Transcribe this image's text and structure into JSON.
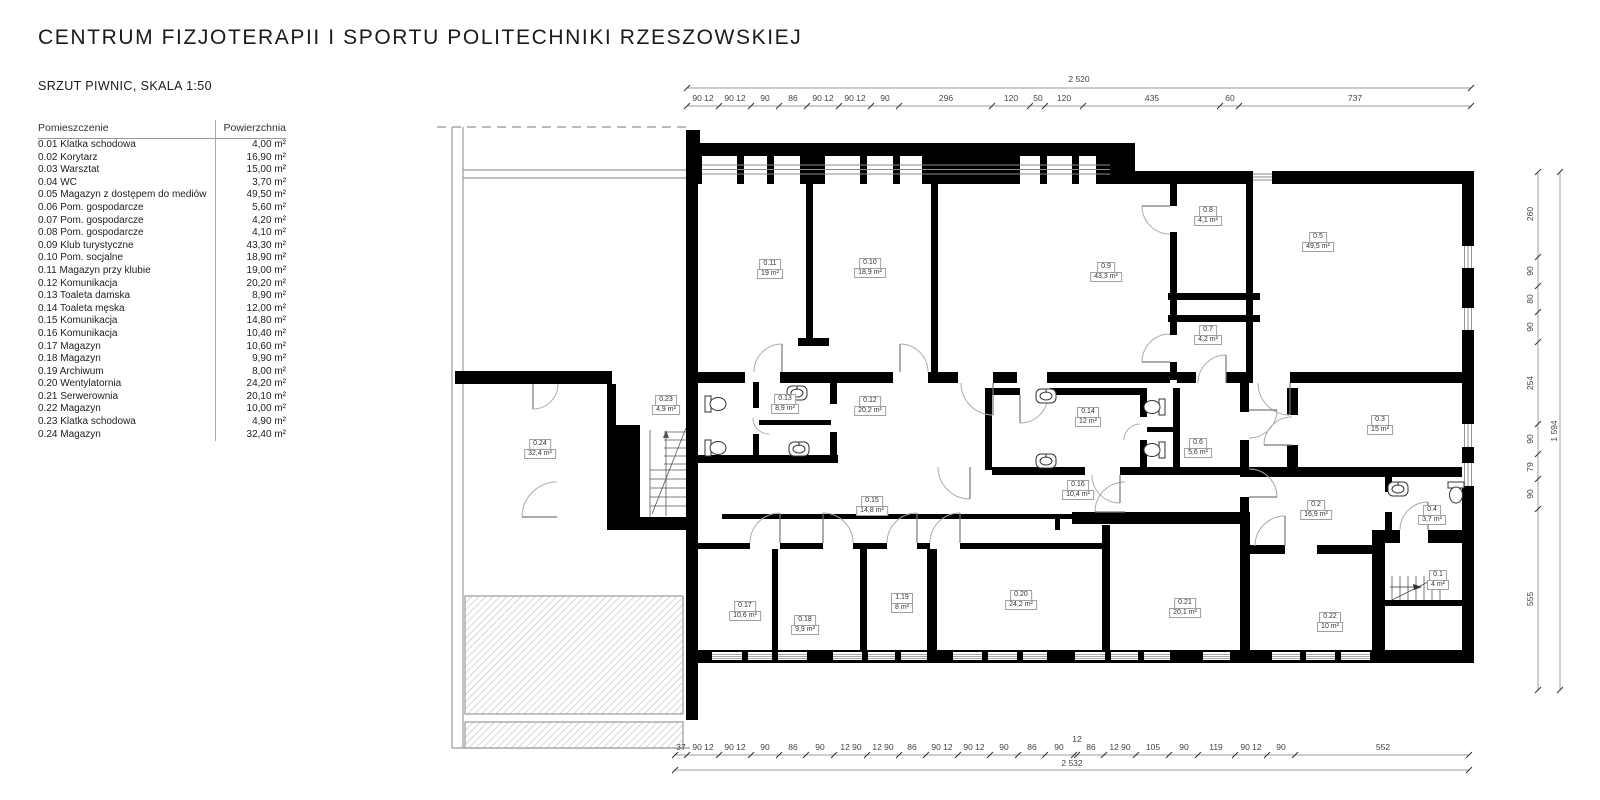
{
  "header": {
    "title": "CENTRUM FIZJOTERAPII I SPORTU POLITECHNIKI RZESZOWSKIEJ",
    "subtitle": "SRZUT PIWNIC, SKALA 1:50"
  },
  "colors": {
    "wall": "#000000",
    "thin_line": "#9a9a9a",
    "text": "#1a1a1a"
  },
  "legend": {
    "col_room": "Pomieszczenie",
    "col_area": "Powierzchnia",
    "rows": [
      {
        "name": "0.01 Klatka schodowa",
        "area": "4,00 m²"
      },
      {
        "name": "0.02 Korytarz",
        "area": "16,90 m²"
      },
      {
        "name": "0.03 Warsztat",
        "area": "15,00 m²"
      },
      {
        "name": "0.04 WC",
        "area": "3,70 m²"
      },
      {
        "name": "0.05 Magazyn z dostępem do mediów",
        "area": "49,50 m²"
      },
      {
        "name": "0.06 Pom. gospodarcze",
        "area": "5,60 m²"
      },
      {
        "name": "0.07 Pom. gospodarcze",
        "area": "4,20 m²"
      },
      {
        "name": "0.08 Pom. gospodarcze",
        "area": "4,10 m²"
      },
      {
        "name": "0.09 Klub turystyczne",
        "area": "43,30 m²"
      },
      {
        "name": "0.10 Pom. socjalne",
        "area": "18,90 m²"
      },
      {
        "name": "0.11 Magazyn przy klubie",
        "area": "19,00 m²"
      },
      {
        "name": "0.12 Komunikacja",
        "area": "20,20 m²"
      },
      {
        "name": "0.13 Toaleta damska",
        "area": "8,90 m²"
      },
      {
        "name": "0.14 Toaleta męska",
        "area": "12,00 m²"
      },
      {
        "name": "0.15 Komunikacja",
        "area": "14,80 m²"
      },
      {
        "name": "0.16 Komunikacja",
        "area": "10,40 m²"
      },
      {
        "name": "0.17 Magazyn",
        "area": "10,60 m²"
      },
      {
        "name": "0.18 Magazyn",
        "area": "9,90 m²"
      },
      {
        "name": "0.19 Archiwum",
        "area": "8,00 m²"
      },
      {
        "name": "0.20 Wentylatornia",
        "area": "24,20 m²"
      },
      {
        "name": "0.21 Serwerownia",
        "area": "20,10 m²"
      },
      {
        "name": "0.22 Magazyn",
        "area": "10,00 m²"
      },
      {
        "name": "0.23 Klatka schodowa",
        "area": "4,90 m²"
      },
      {
        "name": "0.24 Magazyn",
        "area": "32,40 m²"
      }
    ]
  },
  "plan": {
    "icons": [
      "toilet-icon",
      "sink-icon",
      "stairs-icon",
      "door-arc-icon"
    ],
    "room_labels": [
      {
        "id": "0.11",
        "area": "19 m²"
      },
      {
        "id": "0.10",
        "area": "18,9 m²"
      },
      {
        "id": "0.9",
        "area": "43,3 m²"
      },
      {
        "id": "0.8",
        "area": "4,1 m²"
      },
      {
        "id": "0.5",
        "area": "49,5 m²"
      },
      {
        "id": "0.7",
        "area": "4,2 m²"
      },
      {
        "id": "0.23",
        "area": "4,9 m²"
      },
      {
        "id": "0.13",
        "area": "8,9 m²"
      },
      {
        "id": "0.12",
        "area": "20,2 m²"
      },
      {
        "id": "0.14",
        "area": "12 m²"
      },
      {
        "id": "0.6",
        "area": "5,6 m²"
      },
      {
        "id": "0.3",
        "area": "15 m²"
      },
      {
        "id": "0.24",
        "area": "32,4 m²"
      },
      {
        "id": "0.16",
        "area": "10,4 m²"
      },
      {
        "id": "0.15",
        "area": "14,8 m²"
      },
      {
        "id": "0.2",
        "area": "16,9 m²"
      },
      {
        "id": "0.4",
        "area": "3,7 m²"
      },
      {
        "id": "0.1",
        "area": "4 m²"
      },
      {
        "id": "0.17",
        "area": "10,6 m²"
      },
      {
        "id": "0.18",
        "area": "9,9 m²"
      },
      {
        "id": "1.19",
        "area": "8 m²"
      },
      {
        "id": "0.20",
        "area": "24,2 m²"
      },
      {
        "id": "0.21",
        "area": "20,1 m²"
      },
      {
        "id": "0.22",
        "area": "10 m²"
      }
    ]
  },
  "dimensions": {
    "top": {
      "total": "2 520",
      "segments": [
        "90 12",
        "90 12",
        "90",
        "86",
        "90 12",
        "90 12",
        "90",
        "296",
        "120",
        "50",
        "120",
        "435",
        "60",
        "737"
      ]
    },
    "bottom": {
      "total": "2 532",
      "extra": "12",
      "segments": [
        "37",
        "90 12",
        "90 12",
        "90",
        "86",
        "90",
        "12 90",
        "12 90",
        "86",
        "90 12",
        "90 12",
        "90",
        "86",
        "90",
        "86",
        "12 90",
        "105",
        "90",
        "119",
        "90 12",
        "90",
        "552"
      ]
    },
    "right": {
      "total": "1 594",
      "segments": [
        "260",
        "90",
        "80",
        "90",
        "254",
        "90",
        "79",
        "90",
        "555"
      ]
    }
  }
}
